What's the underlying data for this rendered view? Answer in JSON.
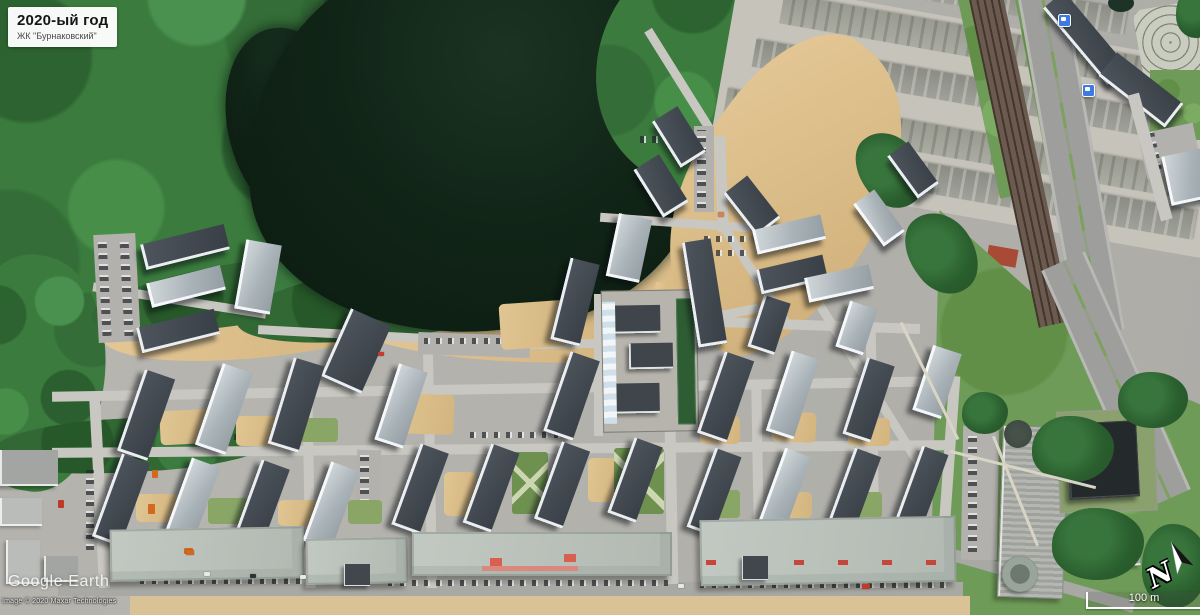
{
  "header": {
    "year_label": "2020-ый год",
    "complex_label": "ЖК \"Бурнаковский\""
  },
  "watermark": {
    "brand": "Google Earth",
    "copyright": "Image © 2020 Maxar Technologies"
  },
  "navigation": {
    "compass_label": "N",
    "scale_label": "100 m"
  },
  "icons": {
    "compass": "north-arrow",
    "transit_stop": "bus-stop"
  },
  "colors": {
    "lake": "#0c1d12",
    "forest": "#3b7c3e",
    "grass": "#6f9b58",
    "sand": "#dcc08e",
    "road": "#c9c7c1",
    "roof_dark": "#424950",
    "roof_light": "#aab3b8",
    "transit_icon": "#3d7ae5",
    "label_bg": "#ffffff"
  }
}
